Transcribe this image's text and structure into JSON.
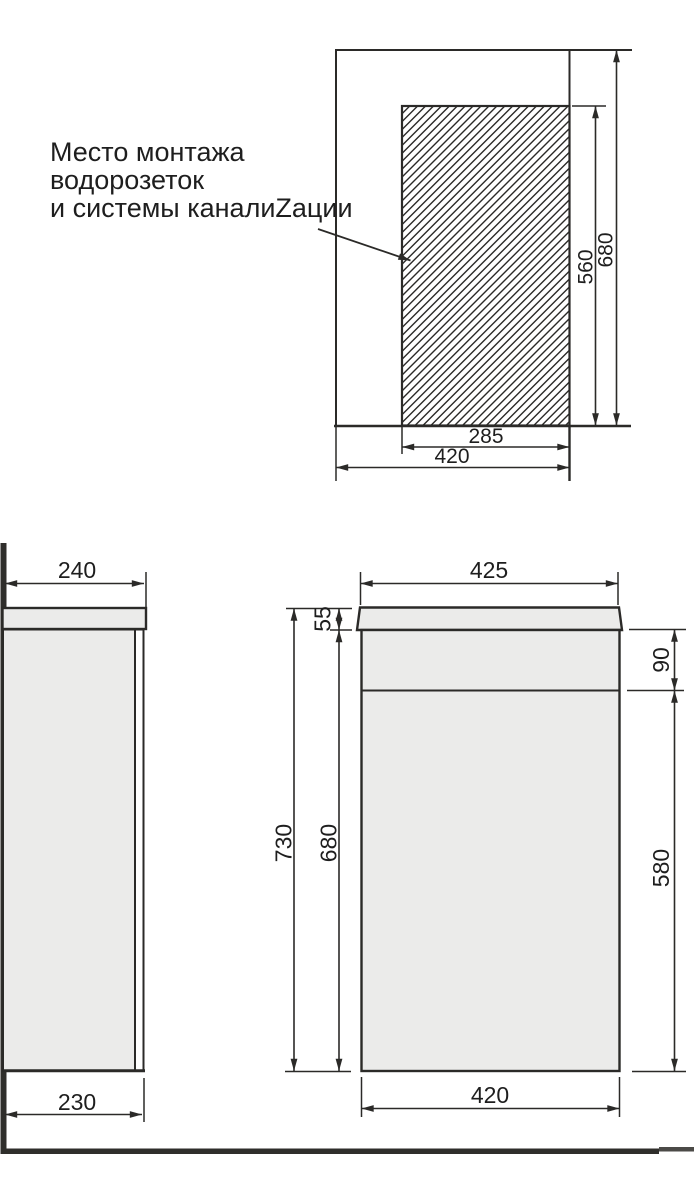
{
  "annotation": {
    "line1": "Место монтажа",
    "line2": "водорозеток",
    "line3": "и системы каналиZации"
  },
  "plan_view": {
    "dim_hatch_height": "560",
    "dim_total_height": "680",
    "dim_hatch_width": "285",
    "dim_total_width": "420"
  },
  "side_view": {
    "dim_depth_with_door": "240",
    "dim_body_depth": "230"
  },
  "front_view": {
    "dim_top_width": "425",
    "dim_total_height": "730",
    "dim_cabinet_height": "680",
    "dim_countertop_thickness": "55",
    "dim_upper_section": "90",
    "dim_lower_section": "580",
    "dim_cabinet_width": "420"
  },
  "colors": {
    "line": "#2b2a28",
    "panel_fill": "#ebebea",
    "hatch_line": "#c7c9c8",
    "wall_floor": "#2f2e2b",
    "text": "#1e1e1e"
  }
}
